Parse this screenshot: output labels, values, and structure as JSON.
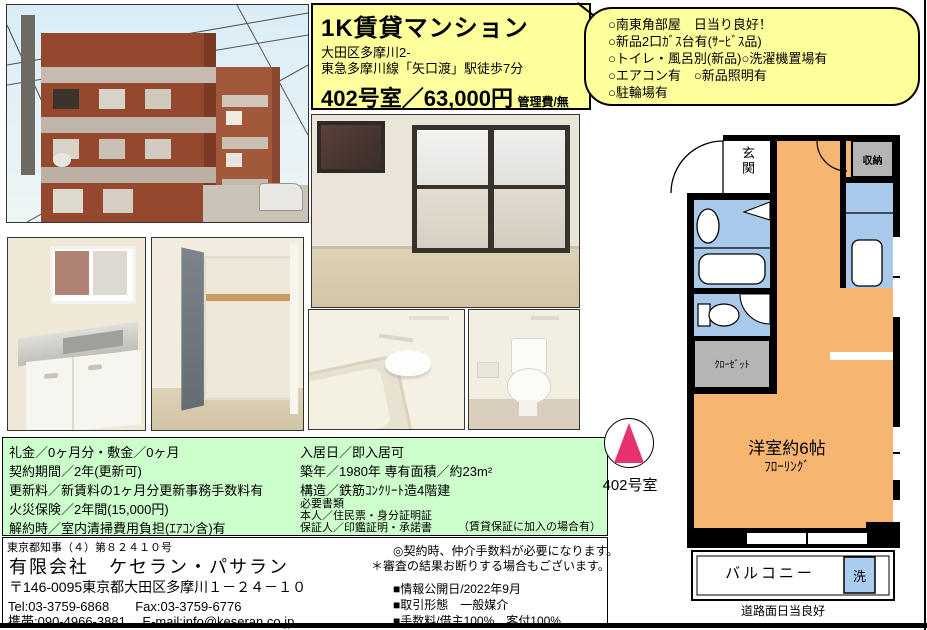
{
  "title_box": {
    "title": "1K賃貸マンション",
    "address": "大田区多摩川2-",
    "access": "東急多摩川線「矢口渡」駅徒歩7分",
    "room_price": "402号室／63,000円",
    "admin_fee": "管理費/無"
  },
  "features": {
    "items": [
      "○南東角部屋　日当り良好！",
      "○新品2口ｶﾞｽ台有(ｻｰﾋﾞｽ品)",
      "○トイレ・風呂別(新品)○洗濯機置場有",
      "○エアコン有　○新品照明有",
      "○駐輪場有"
    ]
  },
  "terms": {
    "left": [
      "礼金／0ヶ月分・敷金／0ヶ月",
      "契約期間／2年(更新可)",
      "更新料／新賃料の1ヶ月分更新事務手数料有",
      "火災保険／2年間(15,000円)",
      "解約時／室内清掃費用負担(ｴｱｺﾝ含)有"
    ],
    "right": [
      "入居日／即入居可",
      "築年／1980年 専有面積／約23m²",
      "構造／鉄筋ｺﾝｸﾘｰﾄ造4階建"
    ],
    "docs_heading": "必要書類",
    "docs": [
      "本人／住民票・身分証明証",
      "保証人／印鑑証明・承諾書"
    ],
    "docs_note": "（賃貸保証に加入の場合有）"
  },
  "company": {
    "license": "東京都知事（４）第８２４１０号",
    "name": "有限会社　ケセラン・パサラン",
    "address": "〒146-0095東京都大田区多摩川１－２４－１０",
    "tel_fax": "Tel:03-3759-6868　　Fax:03-3759-6776",
    "mobile_mail": "携帯:090-4966-3881　 E-mail:info@keseran.co.jp"
  },
  "notes": {
    "line1": "◎契約時、仲介手数料が必要になります。",
    "line2": "＊審査の結果お断りする場合もございます。",
    "items": [
      "■情報公開日/2022年9月",
      "■取引形態　一般媒介",
      "■手数料/借主100%　客付100%"
    ]
  },
  "floorplan": {
    "genkan": "玄関",
    "storage": "収納",
    "closet": "ｸﾛｰｾﾞｯﾄ",
    "room": "洋室約6帖",
    "flooring": "ﾌﾛｰﾘﾝｸﾞ",
    "balcony": "バルコニー",
    "washer": "洗",
    "road": "道路面日当良好",
    "compass_label": "402号室"
  },
  "colors": {
    "highlight_yellow": "#ffff9b",
    "terms_green": "#ccffcc",
    "plan_room_orange": "#f6b571",
    "plan_wet_blue": "#a9c9ea",
    "plan_gray": "#b5b5b5",
    "compass_pink": "#e5336f"
  }
}
